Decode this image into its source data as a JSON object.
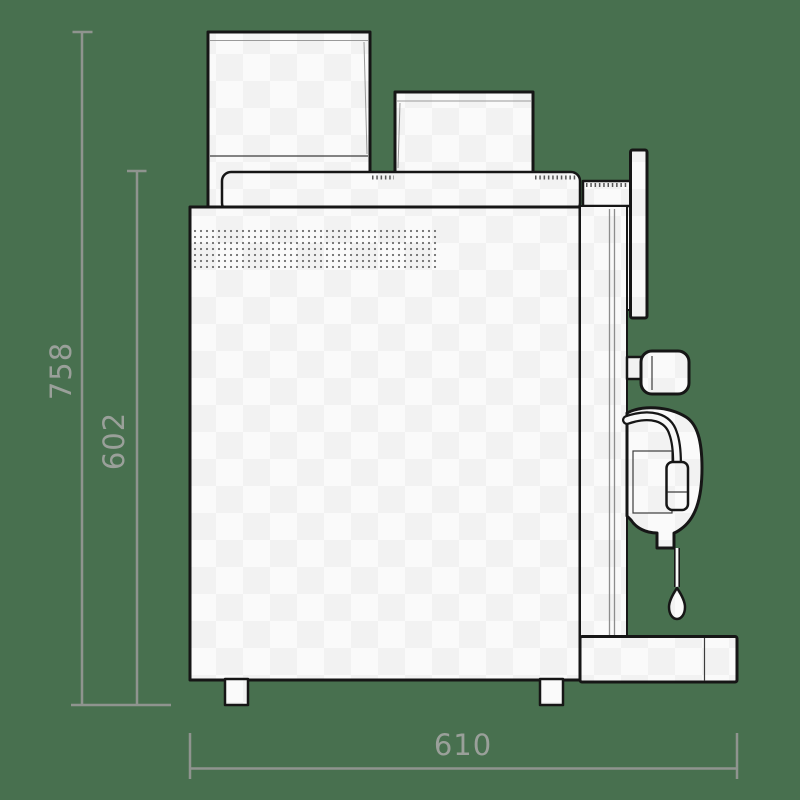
{
  "diagram": {
    "kind": "technical-dimension-drawing",
    "subject": "coffee-machine-side-view"
  },
  "dimensions": {
    "total_height": "758",
    "upper_body_height": "602",
    "total_width": "610"
  },
  "colors": {
    "bg": "#48704f",
    "ink": "#161616",
    "fill": "#f8f8f8",
    "dim": "#8f948f",
    "dimtext": "#9aa09a"
  }
}
